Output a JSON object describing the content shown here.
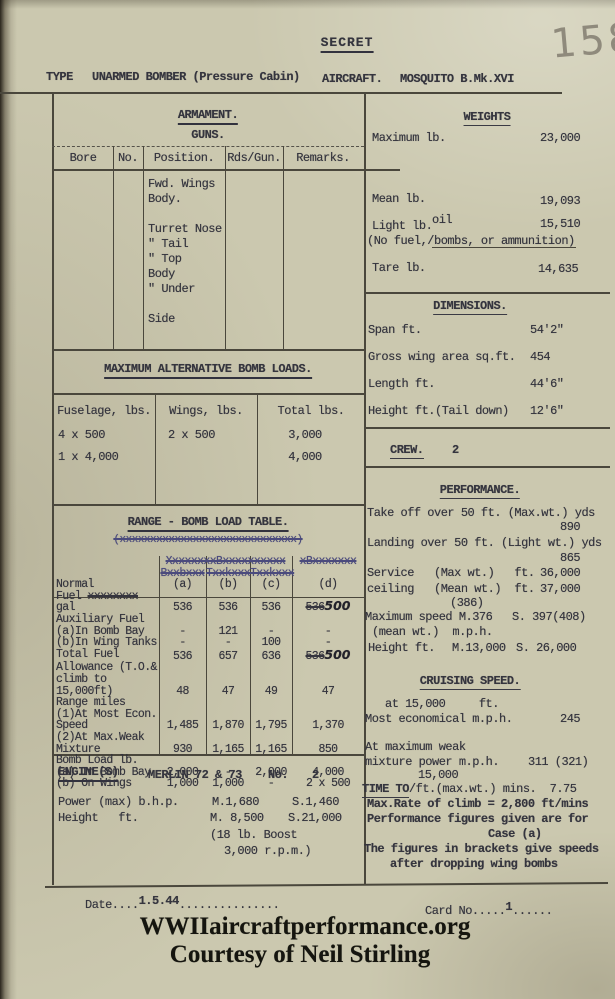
{
  "colors": {
    "paper": "#cbc8af",
    "ink": "#35353e",
    "blue_ink": "#4b4b7d",
    "pencil": "#8f8a7c",
    "rule": "#4a473c"
  },
  "header": {
    "classification": "SECRET",
    "page_number": "158",
    "type_label": "TYPE",
    "type_value": "UNARMED BOMBER (Pressure Cabin)",
    "aircraft_label": "AIRCRAFT.",
    "aircraft_value": "MOSQUITO B.Mk.XVI"
  },
  "armament": {
    "title": "ARMAMENT.",
    "subtitle": "GUNS.",
    "columns": [
      "Bore",
      "No.",
      "Position.",
      "Rds/Gun.",
      "Remarks."
    ],
    "positions": "Fwd. Wings\n      Body.\n\nTurret Nose\n  \"     Tail\n  \"     Top\n     Body\n  \"     Under\n\nSide"
  },
  "bomb_loads": {
    "title": "MAXIMUM ALTERNATIVE BOMB LOADS.",
    "columns": [
      "Fuselage, lbs.",
      "Wings, lbs.",
      "Total lbs."
    ],
    "rows": [
      [
        "4 x 500",
        "2 x 500",
        "3,000"
      ],
      [
        "1 x 4,000",
        "",
        "4,000"
      ]
    ]
  },
  "range_table": {
    "title": "RANGE - BOMB LOAD TABLE.",
    "title_scribble": "(xxxxxxxxxxxxxxxxxxxxxxxxxxxxx)",
    "scribble_span": "XxxxxxxxBxxxxxxxxxx",
    "scribble_d": "xBxxxxxxx",
    "scribble_cols": [
      "Bxxbxxx",
      "Txxkxxx",
      "Txxkxxx"
    ],
    "keys": [
      "(a)",
      "(b)",
      "(c)",
      "(d)"
    ],
    "rows": [
      {
        "label_top": "Normal",
        "label_pre": "Fuel ",
        "label_struck": "xxxxxxxx",
        "label_post": " gal",
        "a": "536",
        "b": "536",
        "c": "536",
        "d_struck": "536",
        "d_hand": "500"
      },
      {
        "label": "Auxiliary Fuel\n(a)In Bomb Bay",
        "a": "-",
        "b": "121",
        "c": "-",
        "d": "-"
      },
      {
        "label": "(b)In Wing Tanks",
        "a": "-",
        "b": "-",
        "c": "100",
        "d": "-"
      },
      {
        "label": "Total Fuel",
        "a": "536",
        "b": "657",
        "c": "636",
        "d_struck": "536",
        "d_hand": "500"
      },
      {
        "label": "Allowance (T.O.&\nclimb to 15,000ft)",
        "a": "48",
        "b": "47",
        "c": "49",
        "d": "47"
      },
      {
        "label": "Range miles\n(1)At Most Econ.\n        Speed",
        "a": "1,485",
        "b": "1,870",
        "c": "1,795",
        "d": "1,370"
      },
      {
        "label": "(2)At Max.Weak\n        Mixture",
        "a": "930",
        "b": "1,165",
        "c": "1,165",
        "d": "850"
      },
      {
        "label": "Bomb Load lb.\n(a) In Bomb Bay",
        "a": "2,000",
        "b": "-",
        "c": "2,000",
        "d": "4,000"
      },
      {
        "label": "(b) On Wings",
        "a": "1,000",
        "b": "1,000",
        "c": "-",
        "d": "2 x 500"
      }
    ]
  },
  "engine": {
    "title": "ENGINE(S)",
    "name": "MERLIN 72 & 73",
    "no_label": "No.",
    "no_value": "2",
    "power_label": "Power (max) b.h.p.",
    "power_m": "M.1,680",
    "power_s": "S.1,460",
    "height_label": "Height   ft.",
    "height_m": "M. 8,500",
    "height_s": "S.21,000",
    "boost_note": "(18 lb. Boost",
    "rpm_note": "3,000 r.p.m.)"
  },
  "weights": {
    "title": "WEIGHTS",
    "max_label": "Maximum lb.",
    "max_value": "23,000",
    "mean_label": "Mean lb.",
    "mean_value": "19,093",
    "light_label": "Light lb.",
    "light_insert": "oil",
    "light_value": "15,510",
    "light_note": "(No fuel,/bombs, or ammunition)",
    "tare_label": "Tare lb.",
    "tare_value": "14,635"
  },
  "dimensions": {
    "title": "DIMENSIONS.",
    "rows": [
      {
        "label": "Span ft.",
        "value": "54'2\""
      },
      {
        "label": "Gross wing area sq.ft.",
        "value": "454"
      },
      {
        "label": "Length ft.",
        "value": "44'6\""
      },
      {
        "label": "Height ft.(Tail down)",
        "value": "12'6\""
      }
    ]
  },
  "crew": {
    "label": "CREW.",
    "value": "2"
  },
  "performance": {
    "title": "PERFORMANCE.",
    "takeoff_label": "Take off over 50 ft. (Max.wt.) yds",
    "takeoff_value": "890",
    "landing_label": "Landing over 50 ft. (Light wt.) yds",
    "landing_value": "865",
    "service_label": "Service   (Max wt.)   ft.",
    "service_value": "36,000",
    "ceiling_label": "ceiling   (Mean wt.)  ft.",
    "ceiling_value": "37,000",
    "speed_insert": "(386)",
    "speed_label": "Maximum speed M.376",
    "speed_s_value": "S. 397(408)",
    "speed_sub": "(mean wt.)  m.p.h.",
    "height_label": "Height ft.",
    "height_m": "M.13,000",
    "height_s": "S. 26,000"
  },
  "cruising": {
    "title": "CRUISING SPEED.",
    "alt_line": "at 15,000     ft.",
    "econ_label": "Most economical m.p.h.",
    "econ_value": "245",
    "weak_line1": "At maximum weak",
    "weak_line2": "mixture power m.p.h.",
    "weak_value": "311 (321)",
    "time_insert": "15,000",
    "time_label": "TIME TO",
    "time_rest": "/ft.(max.wt.) mins.  7.75",
    "climb_line": "Max.Rate of climb = 2,800 ft/mins",
    "note_1": "Performance figures given are for",
    "note_2": "Case (a)",
    "note_3": "The figures in brackets give speeds",
    "note_4": "after dropping wing bombs"
  },
  "footer": {
    "date_label": "Date....",
    "date_value": "1.5.44",
    "date_dots": "...............",
    "card_label": "Card No.....",
    "card_value": "1",
    "card_dots": "......",
    "watermark_line1": "WWIIaircraftperformance.org",
    "watermark_line2": "Courtesy of Neil Stirling"
  }
}
